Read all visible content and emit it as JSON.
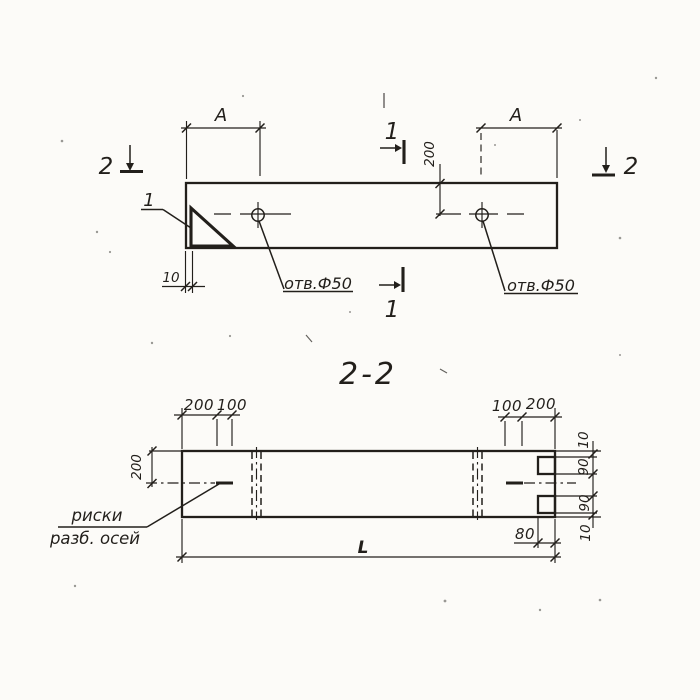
{
  "colors": {
    "ink": "#221f1b",
    "paper": "#fcfbf8"
  },
  "plan_view": {
    "dim_a_left": "A",
    "dim_a_right": "A",
    "dim_hole_offset": "200",
    "dim_chamfer": "10",
    "hole_note_left": "отв.Ф50",
    "hole_note_right": "отв.Ф50",
    "detail_label": "1",
    "section_mark_1_top": "1",
    "section_mark_1_bottom": "1",
    "section_mark_2_left": "2",
    "section_mark_2_right": "2"
  },
  "section_view": {
    "title": "2-2",
    "dims_top_left": [
      "200",
      "100"
    ],
    "dims_top_right": [
      "100",
      "200"
    ],
    "dim_half_height": "200",
    "dims_right_side": [
      "10",
      "90",
      "90",
      "10"
    ],
    "dim_notch_depth": "80",
    "dim_length": "L",
    "axis_note_line1": "риски",
    "axis_note_line2": "разб. осей"
  }
}
